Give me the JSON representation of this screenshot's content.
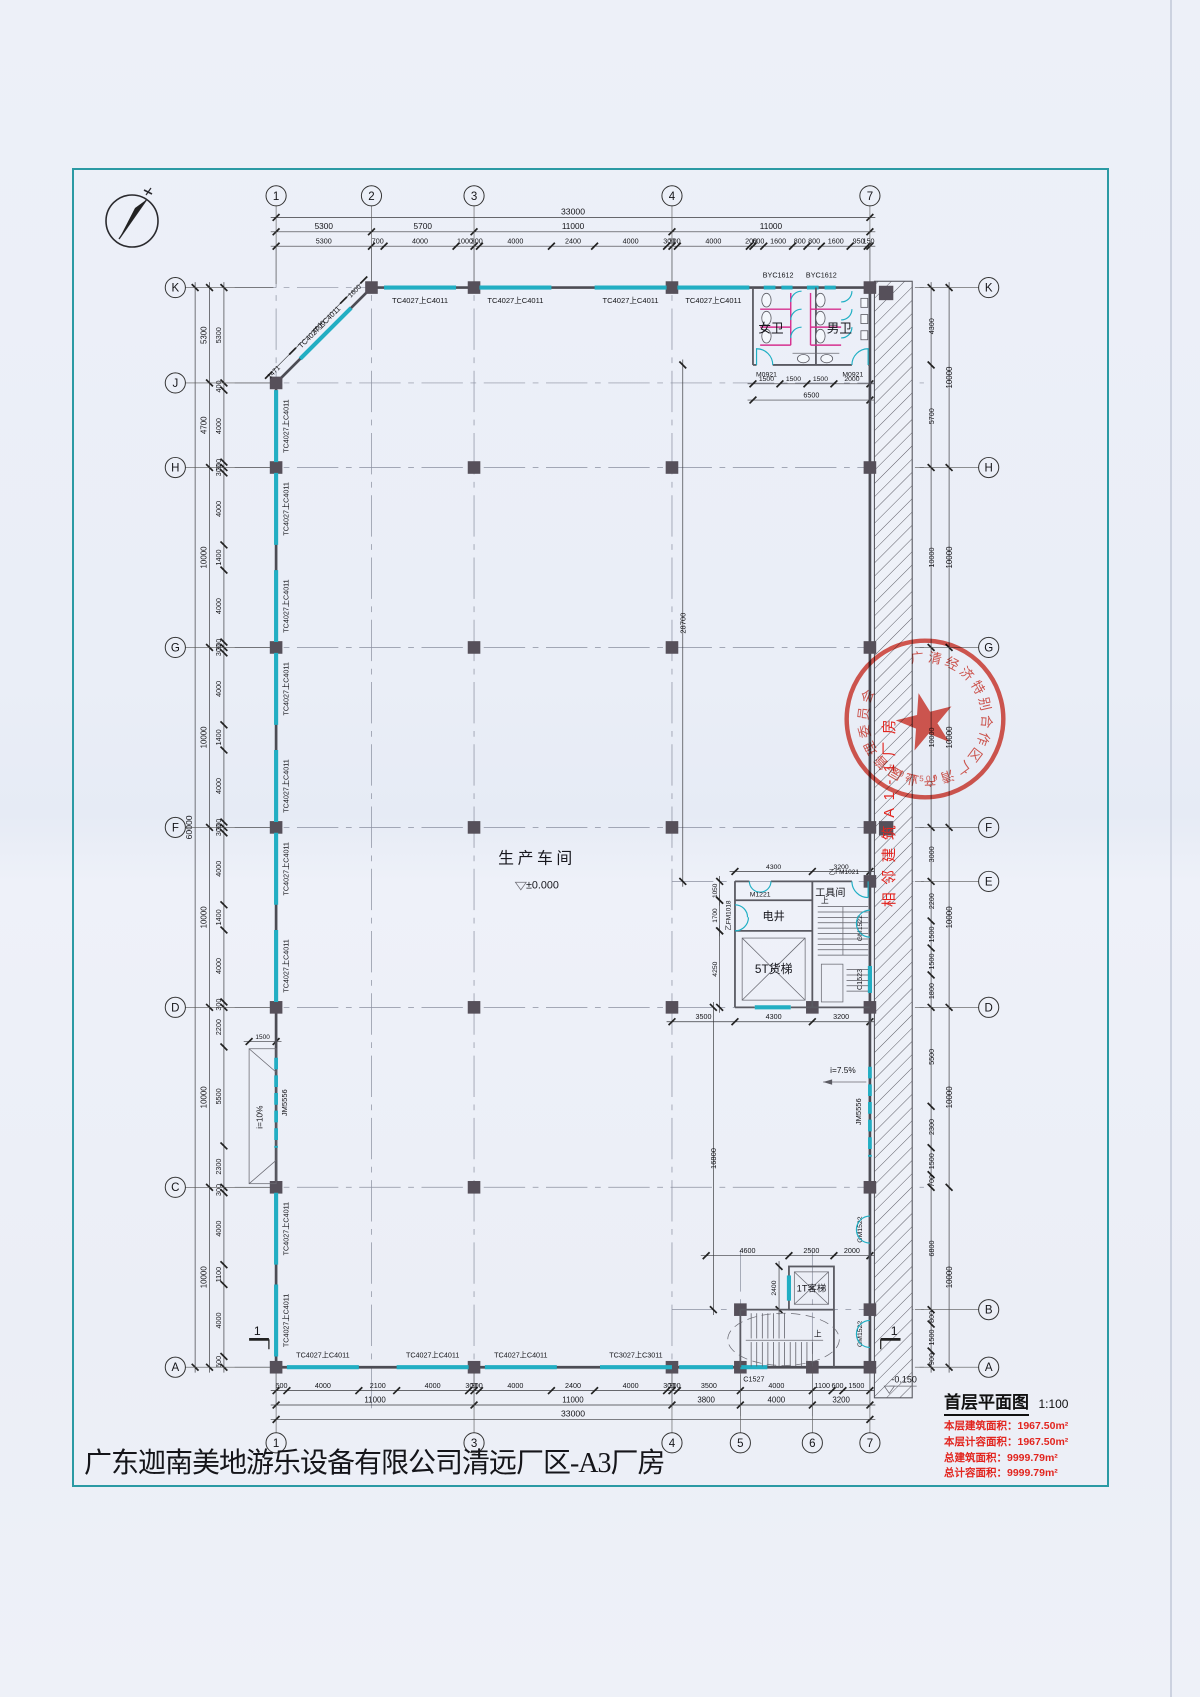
{
  "page": {
    "title_block": "广东迦南美地游乐设备有限公司清远厂区-A3厂房"
  },
  "notes": {
    "plan_title": "首层平面图",
    "scale": "1:100",
    "lines": [
      "本层建筑面积：1967.50m²",
      "本层计容面积：1967.50m²",
      "总建筑面积：9999.79m²",
      "总计容面积：9999.79m²"
    ]
  },
  "grid": {
    "cols_top": [
      "1",
      "2",
      "3",
      "4",
      "7"
    ],
    "cols_bottom": [
      "1",
      "3",
      "4",
      "5",
      "6",
      "7"
    ],
    "rows_left": [
      "K",
      "J",
      "H",
      "G",
      "F",
      "D",
      "C",
      "A"
    ],
    "rows_right": [
      "K",
      "H",
      "G",
      "F",
      "E",
      "D",
      "B",
      "A"
    ]
  },
  "dims": {
    "top_total": [
      "33000"
    ],
    "top_major": [
      "5300",
      "5700",
      "11000",
      "11000"
    ],
    "top_detail": [
      "5300",
      "700",
      "4000",
      "1000",
      "300",
      "4000",
      "2400",
      "4000",
      "300",
      "300",
      "4000",
      "200",
      "600",
      "1600",
      "800",
      "800",
      "1600",
      "950",
      "150"
    ],
    "left_total": [
      "60000"
    ],
    "left_major": [
      "5300",
      "4700",
      "10000",
      "10000",
      "10000",
      "10000",
      "10000"
    ],
    "left_detail": [
      "5300",
      "400",
      "4000",
      "300",
      "300",
      "4000",
      "1400",
      "4000",
      "300",
      "300",
      "4000",
      "1400",
      "4000",
      "300",
      "300",
      "4000",
      "1400",
      "4000",
      "300",
      "2200",
      "5500",
      "2300",
      "300",
      "4000",
      "1100",
      "4000",
      "600"
    ],
    "right_outer": [
      "10000",
      "10000",
      "10000",
      "10000",
      "10000",
      "10000"
    ],
    "right_detail": [
      "4300",
      "5700",
      "10000",
      "10000",
      "3000",
      "2200",
      "1500",
      "1500",
      "1800",
      "5500",
      "2300",
      "1500",
      "700",
      "6800",
      "800",
      "1500",
      "900"
    ],
    "bottom_total": [
      "33000"
    ],
    "bottom_major": [
      "11000",
      "11000",
      "3800",
      "4000",
      "3200"
    ],
    "bottom_detail": [
      "600",
      "4000",
      "2100",
      "4000",
      "300",
      "300",
      "4000",
      "2400",
      "4000",
      "300",
      "300",
      "3500",
      "4000",
      "1100",
      "600",
      "1500"
    ],
    "diag": [
      "1600",
      "4000",
      "1471"
    ],
    "toilet": [
      "1500",
      "1500",
      "1500",
      "2000"
    ],
    "toilet_total": [
      "6500"
    ],
    "core_e": [
      "4300",
      "3200"
    ],
    "core_d": [
      "3500",
      "4300",
      "3200"
    ],
    "lift": [
      "4600",
      "2500",
      "2000"
    ],
    "h28700": [
      "28700"
    ],
    "v16800": [
      "16800"
    ],
    "v4250": [
      "4250"
    ],
    "v1050": [
      "1050"
    ],
    "v1700": [
      "1700"
    ],
    "v2400": [
      "2400"
    ],
    "r1500": [
      "1500"
    ]
  },
  "labels": {
    "tc4027": "TC4027上C4011",
    "tc3027": "TC3027上C3011",
    "byc": "BYC1612",
    "m0921": "M0921",
    "m1221": "M1221",
    "fm1018": "乙FM1018",
    "fm1021": "乙FM1021",
    "gm1522": "GM1522",
    "jm5556": "JM5556",
    "c1523": "C1523",
    "c1527": "C1527"
  },
  "rooms": {
    "workshop": "生产车间",
    "workshop_level": "±0.000",
    "tool": "工具间",
    "eshaft": "电井",
    "freight": "5T货梯",
    "passenger": "1T客梯",
    "women": "女卫",
    "men": "男卫"
  },
  "marks": {
    "outdoor_level": "-0.150",
    "ramp_left": "i=10%",
    "ramp_right": "i=7.5%",
    "section": "1",
    "up": "上",
    "adjacent_note": "相邻建筑A1-1厂房"
  },
  "stamp": {
    "ring_text": "广清经济特别合作区广清产业园管理委员会",
    "serial": "4418029509"
  },
  "colors": {
    "frame_teal": "#2b9aa4",
    "window_teal": "#22aec3",
    "partition_pink": "#d6308f",
    "stamp_red": "#d93a2e",
    "note_red": "#e2251f",
    "wall": "#4c4c54"
  }
}
